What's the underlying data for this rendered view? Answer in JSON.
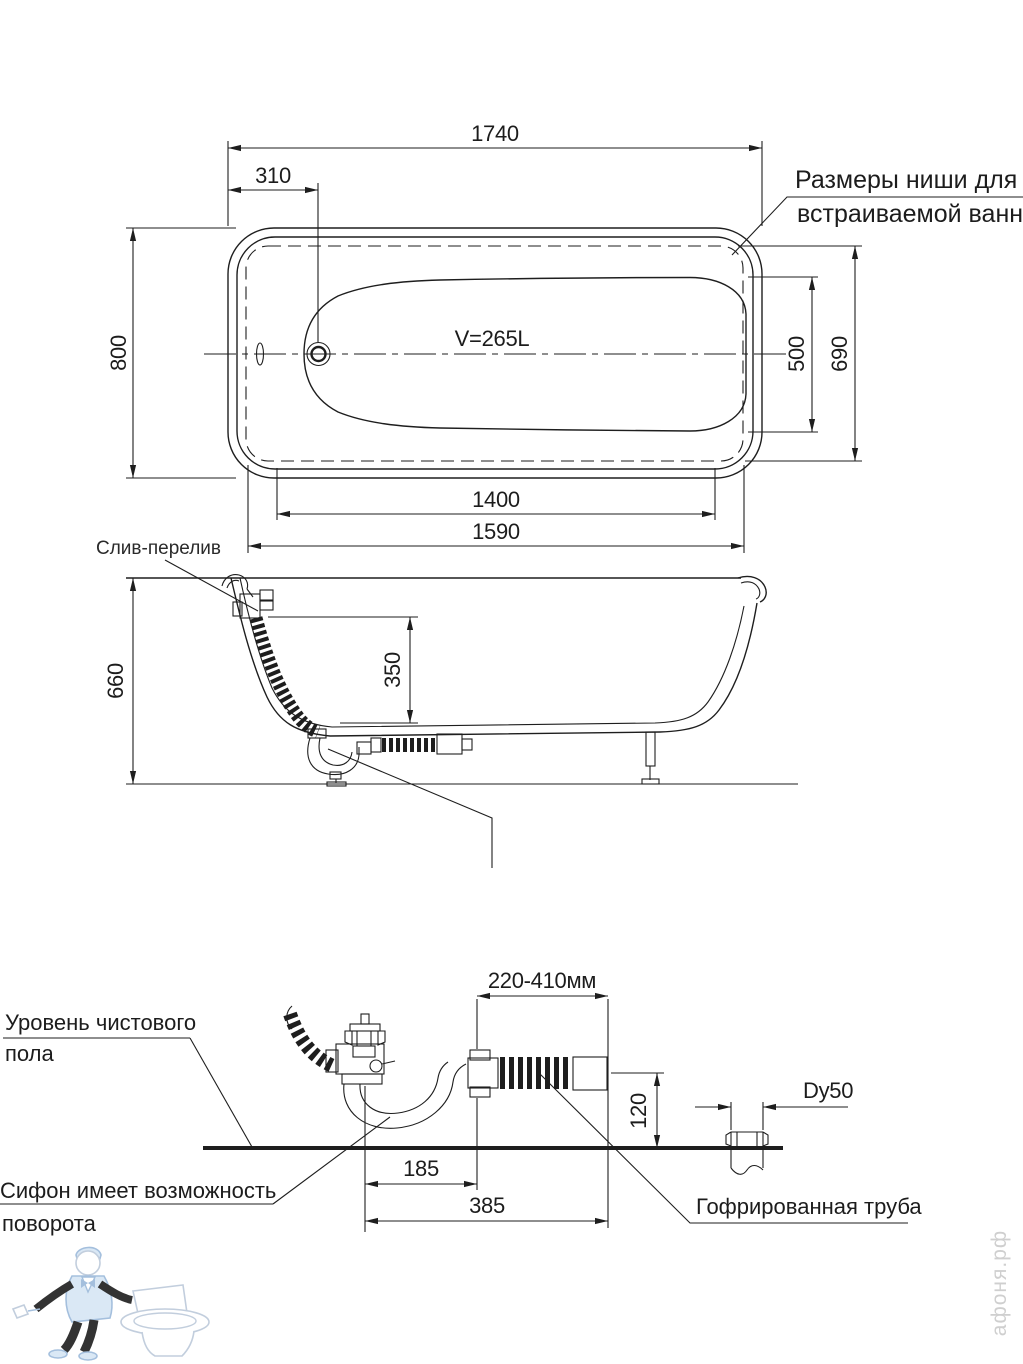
{
  "top": {
    "dim_length": "1740",
    "dim_drain_offset": "310",
    "dim_width": "800",
    "dim_inner_width": "500",
    "dim_niche_width": "690",
    "dim_inner_length": "1400",
    "dim_niche_length": "1590",
    "volume": "V=265L",
    "note_line1": "Размеры ниши для",
    "note_line2": "встраиваемой ванны"
  },
  "side": {
    "label_overflow": "Слив-перелив",
    "dim_height": "660",
    "dim_depth": "350"
  },
  "detail": {
    "label_floor1": "Уровень чистового",
    "label_floor2": "пола",
    "label_siphon1": "Сифон имеет возможность",
    "label_siphon2": "поворота",
    "label_pipe": "Гофрированная труба",
    "dim_range": "220-410мм",
    "dim_height": "120",
    "dim_a": "185",
    "dim_b": "385",
    "label_dy": "Dy50"
  },
  "watermark": {
    "site": "афоня.рф"
  },
  "colors": {
    "line": "#1e1e1e",
    "watermark_blue": "#9bb9da",
    "watermark_gray": "#cfcfcf"
  }
}
